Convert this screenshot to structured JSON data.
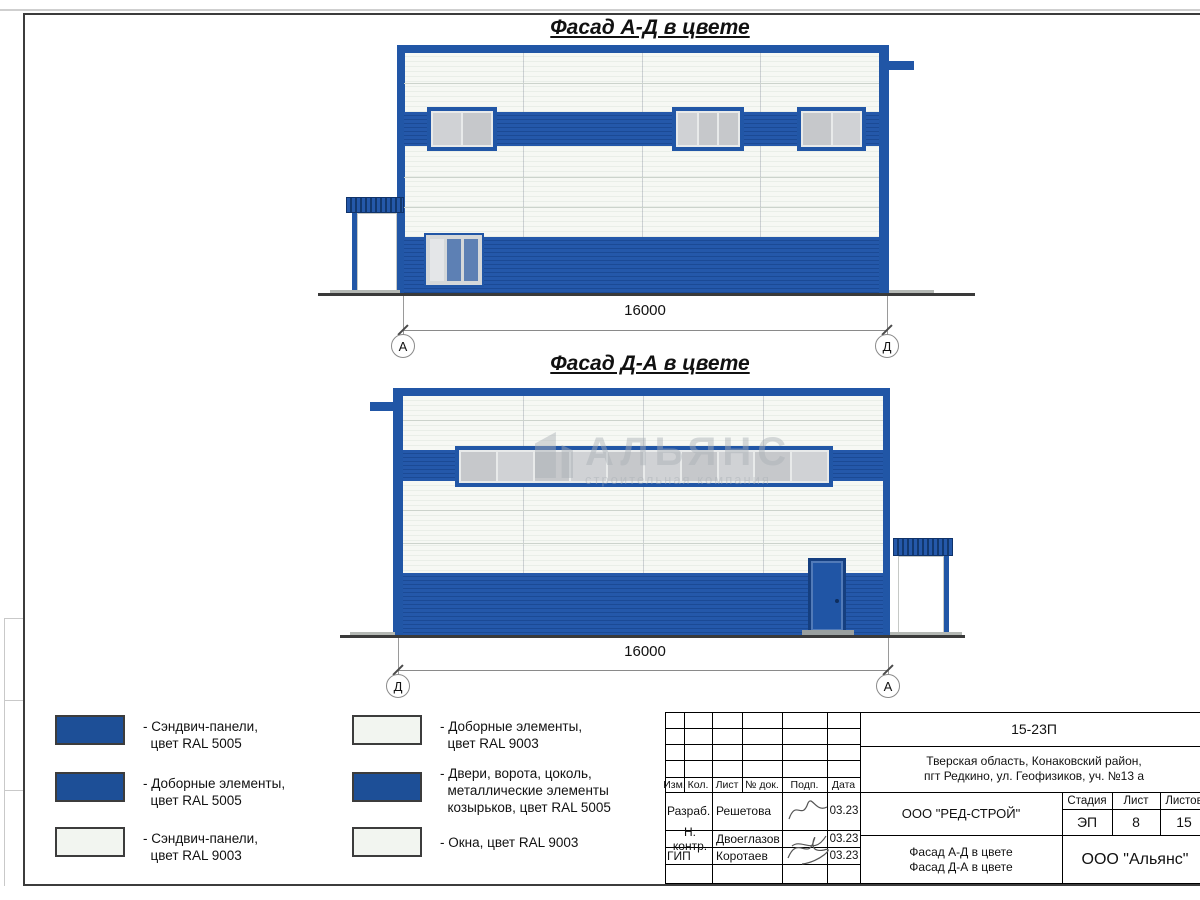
{
  "facade1": {
    "title": "Фасад А-Д в цвете",
    "dim": "16000",
    "axis_left": "А",
    "axis_right": "Д"
  },
  "facade2": {
    "title": "Фасад Д-А в цвете",
    "dim": "16000",
    "axis_left": "Д",
    "axis_right": "А"
  },
  "watermark": {
    "name": "АЛЬЯНС",
    "tagline": "строительная компания"
  },
  "colors": {
    "ral5005_panels": "#1d4f97",
    "ral5005_elements": "#2156a6",
    "ral9003": "#f2f5f0"
  },
  "legend": {
    "items": [
      {
        "color": "#1d4f97",
        "label": "- Сэндвич-панели,\n  цвет RAL 5005"
      },
      {
        "color": "#1d4f97",
        "label": "- Доборные элементы,\n  цвет RAL 5005"
      },
      {
        "color": "#f2f5f0",
        "label": "- Сэндвич-панели,\n  цвет RAL 9003"
      },
      {
        "color": "#f2f5f0",
        "label": "- Доборные элементы,\n  цвет RAL 9003"
      },
      {
        "color": "#1d4f97",
        "label": "- Двери, ворота, цоколь,\n  металлические элементы\n  козырьков, цвет RAL 5005"
      },
      {
        "color": "#f2f5f0",
        "label": "- Окна, цвет RAL 9003"
      }
    ]
  },
  "titleblock": {
    "doc_number": "15-23П",
    "location": "Тверская область, Конаковский район,\nпгт Редкино, ул. Геофизиков, уч. №13 а",
    "cols": {
      "izm": "Изм.",
      "kol": "Кол.",
      "list": "Лист",
      "ndok": "№ док.",
      "podp": "Подп.",
      "data": "Дата"
    },
    "rows": [
      {
        "role": "Разраб.",
        "name": "Решетова",
        "date": "03.23"
      },
      {
        "role": "Н. контр.",
        "name": "Двоеглазов",
        "date": "03.23"
      },
      {
        "role": "ГИП",
        "name": "Коротаев",
        "date": "03.23"
      }
    ],
    "company": "ООО \"РЕД-СТРОЙ\"",
    "sheet_title": "Фасад А-Д в цвете\nФасад Д-А в цвете",
    "stage_label": "Стадия",
    "stage_value": "ЭП",
    "sheet_label": "Лист",
    "sheet_value": "8",
    "sheets_label": "Листов",
    "sheets_value": "15",
    "org": "ООО \"Альянс\""
  }
}
